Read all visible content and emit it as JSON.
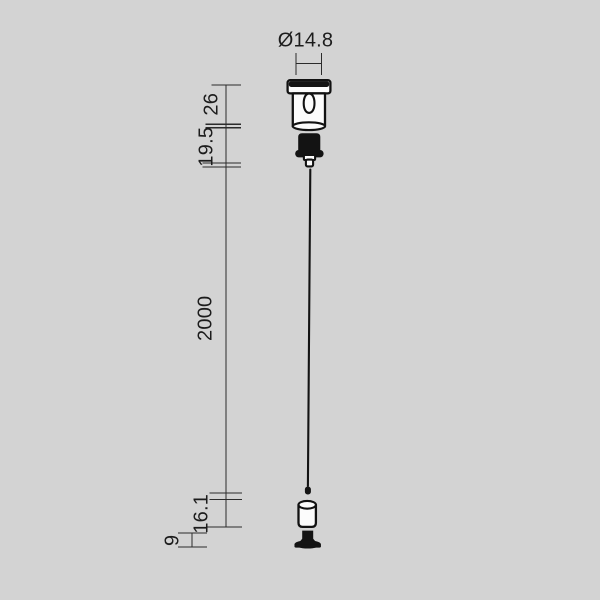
{
  "drawing": {
    "kind": "technical-dimension-drawing",
    "subject": "single suspension cable kit with ceiling fixing and end fastener"
  },
  "dimensions": {
    "diameter": {
      "label": "Ø14.8"
    },
    "segments": [
      {
        "label": "26",
        "measures": "top fixing body height"
      },
      {
        "label": "19.5",
        "measures": "gripper nut height"
      },
      {
        "label": "2000",
        "measures": "suspension wire length"
      },
      {
        "label": "16.1",
        "measures": "end fitting height"
      },
      {
        "label": "9",
        "measures": "mounting base height"
      }
    ]
  },
  "colors": {
    "background": "#d3d3d3",
    "line": "#2b2b2b",
    "part_stroke": "#121212",
    "part_fill": "#fcfcfc",
    "text": "#1c1c1c"
  }
}
